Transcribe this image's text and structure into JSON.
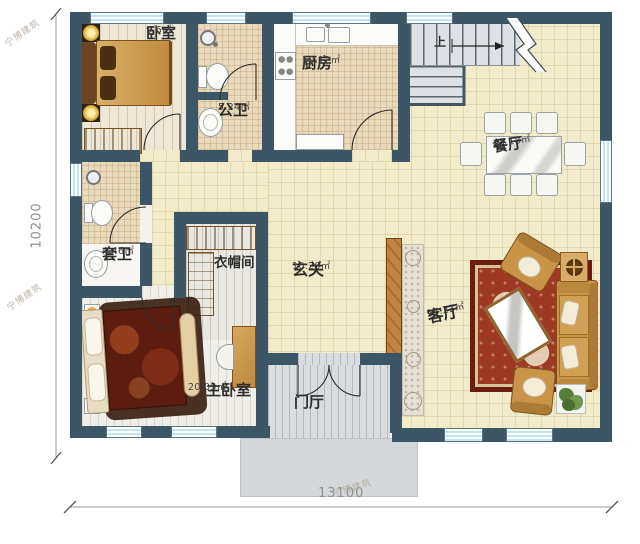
{
  "watermark": {
    "text": "宁博建筑"
  },
  "dimensions": {
    "width_label": "13100",
    "height_label": "10200"
  },
  "stairs": {
    "up_label": "上"
  },
  "rooms": {
    "bedroom": {
      "name": "卧室",
      "area": "9.6㎡"
    },
    "public_bath": {
      "name": "公卫",
      "area": "5.24㎡"
    },
    "kitchen": {
      "name": "厨房",
      "area": "10.12㎡"
    },
    "dining": {
      "name": "餐厅",
      "area": "13.18㎡"
    },
    "ensuite_bath": {
      "name": "套卫",
      "area": "4.46㎡"
    },
    "cloakroom": {
      "name": "衣帽间"
    },
    "hall": {
      "name": "玄关",
      "area": "10.20㎡"
    },
    "living": {
      "name": "客厅",
      "area": "24.23㎡"
    },
    "master_bedroom": {
      "name": "主卧室",
      "area": "20.05㎡"
    },
    "foyer": {
      "name": "门厅"
    }
  },
  "colors": {
    "wall": "#3c5666",
    "floor": "#f2ebc9",
    "window": "#d6edf6",
    "wood": "#bd8a40",
    "rug": "#96311d"
  }
}
